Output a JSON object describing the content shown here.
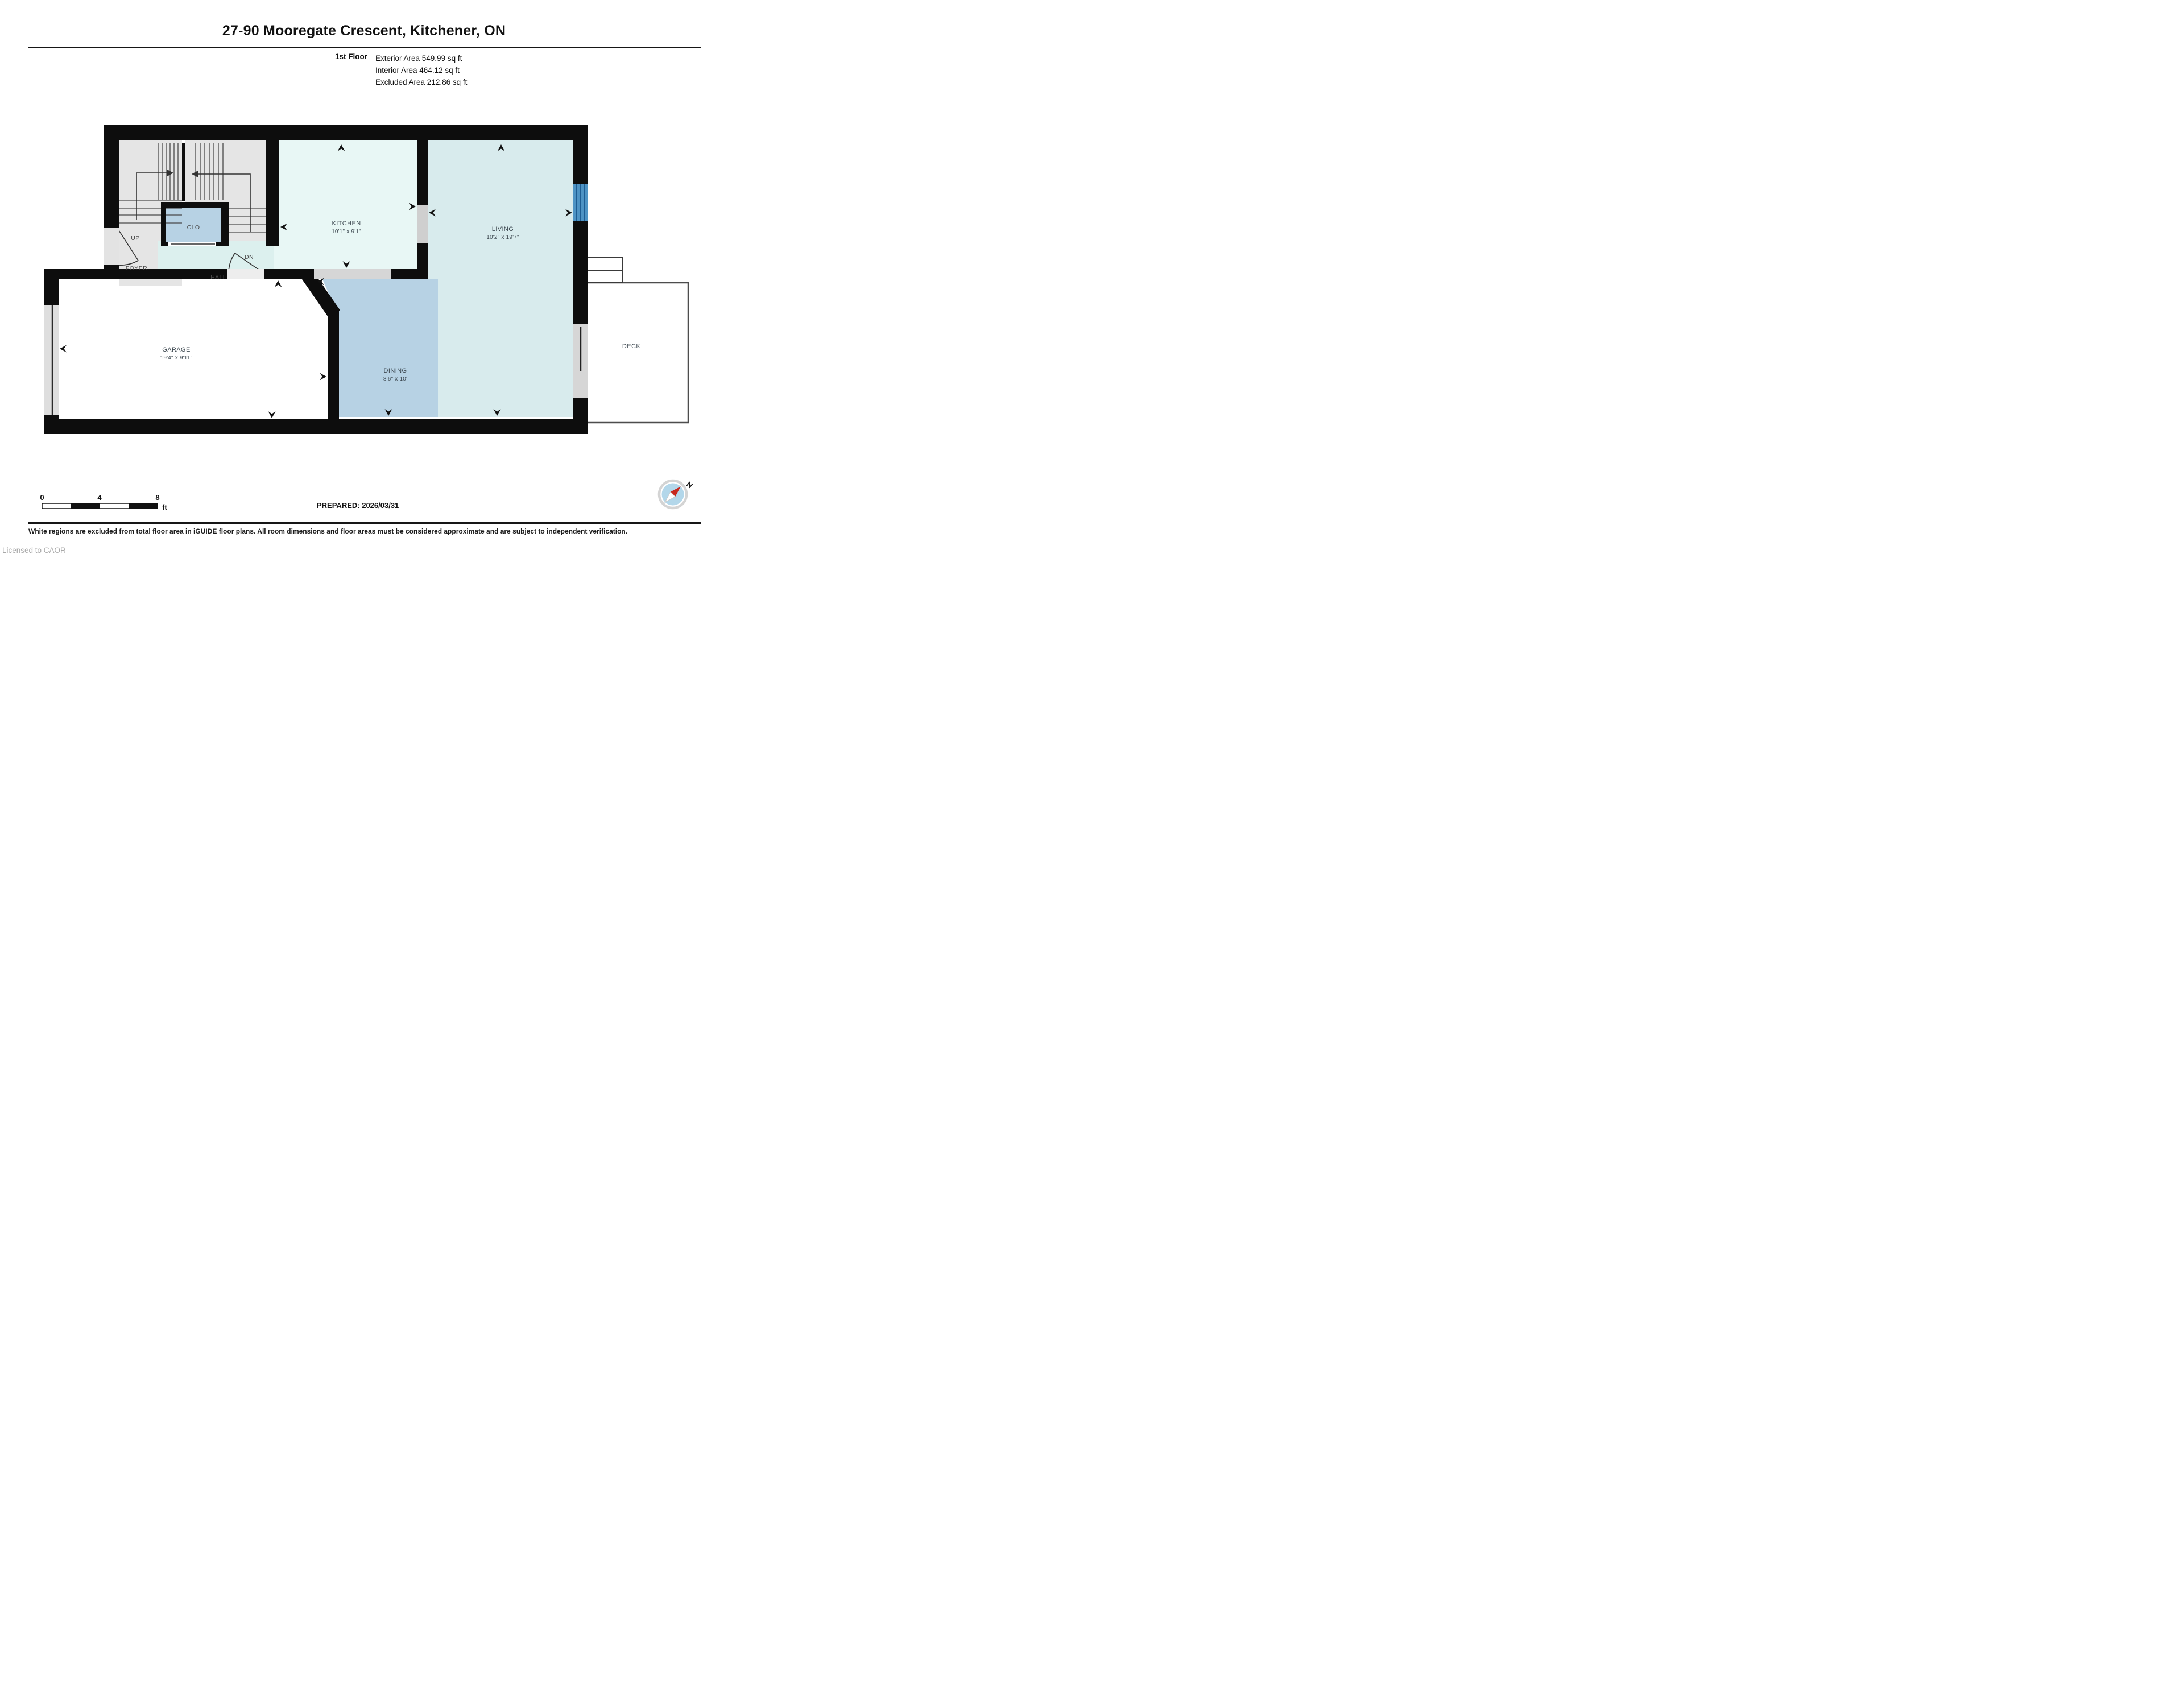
{
  "header": {
    "title": "27-90 Mooregate Crescent, Kitchener, ON",
    "floor_label": "1st Floor",
    "area_lines": {
      "exterior": "Exterior Area 549.99 sq ft",
      "interior": "Interior Area 464.12 sq ft",
      "excluded": "Excluded Area 212.86 sq ft"
    }
  },
  "rooms": {
    "kitchen": {
      "name": "KITCHEN",
      "dims": "10'1\" x 9'1\""
    },
    "living": {
      "name": "LIVING",
      "dims": "10'2\" x 19'7\""
    },
    "dining": {
      "name": "DINING",
      "dims": "8'6\" x 10'"
    },
    "garage": {
      "name": "GARAGE",
      "dims": "19'4\" x 9'11\""
    },
    "deck": {
      "name": "DECK"
    },
    "foyer": {
      "name": "FOYER"
    },
    "hall": {
      "name": "HALL"
    },
    "closet": {
      "name": "CLO"
    },
    "stairs_up": {
      "name": "UP"
    },
    "stairs_down": {
      "name": "DN"
    }
  },
  "scale_bar": {
    "tick_0": "0",
    "tick_4": "4",
    "tick_8": "8",
    "unit": "ft"
  },
  "prepared": "PREPARED: 2026/03/31",
  "compass": {
    "north_label": "N"
  },
  "footer": {
    "disclaimer": "White regions are excluded from total floor area in iGUIDE floor plans. All room dimensions and floor areas must be considered approximate and are subject to independent verification.",
    "license": "Licensed to CAOR"
  },
  "colors": {
    "wall": "#0d0d0d",
    "kitchen": "#e8f7f5",
    "living": "#d8ebed",
    "dining": "#b7d2e4",
    "hall": "#dcf0ee",
    "stairs": "#e5e5e5",
    "closet": "#b7d2e4",
    "opening": "#d6d6d6",
    "window_blue": "#4e93c4",
    "compass_inner": "#b3d7ea",
    "compass_red": "#c8281e"
  }
}
